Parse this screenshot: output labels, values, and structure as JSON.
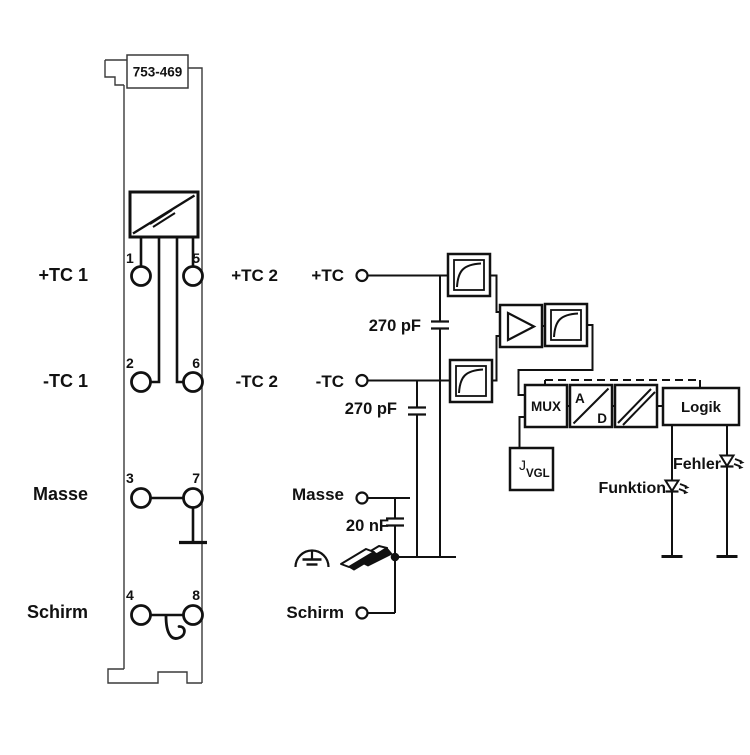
{
  "module": {
    "part_number": "753-469",
    "terminals": {
      "t1": "1",
      "t2": "2",
      "t3": "3",
      "t4": "4",
      "t5": "5",
      "t6": "6",
      "t7": "7",
      "t8": "8"
    },
    "left_labels": {
      "row1": "+TC 1",
      "row2": "-TC 1",
      "row3": "Masse",
      "row4": "Schirm"
    },
    "right_labels": {
      "row1": "+TC 2",
      "row2": "-TC 2"
    }
  },
  "schematic": {
    "inputs": {
      "tc_plus": "+TC",
      "tc_minus": "-TC",
      "masse": "Masse",
      "schirm": "Schirm"
    },
    "capacitors": {
      "c1": "270 pF",
      "c2": "270 pF",
      "c3": "20 nF"
    },
    "blocks": {
      "mux": "MUX",
      "adc_top": "A",
      "adc_bottom": "D",
      "logic": "Logik",
      "cjc_prefix": "J",
      "cjc_sub": "VGL"
    },
    "leds": {
      "function_label": "Funktion",
      "error_label": "Fehler"
    }
  },
  "colors": {
    "ink": "#111111",
    "module_outline": "#3a3a3a",
    "background": "#ffffff"
  }
}
